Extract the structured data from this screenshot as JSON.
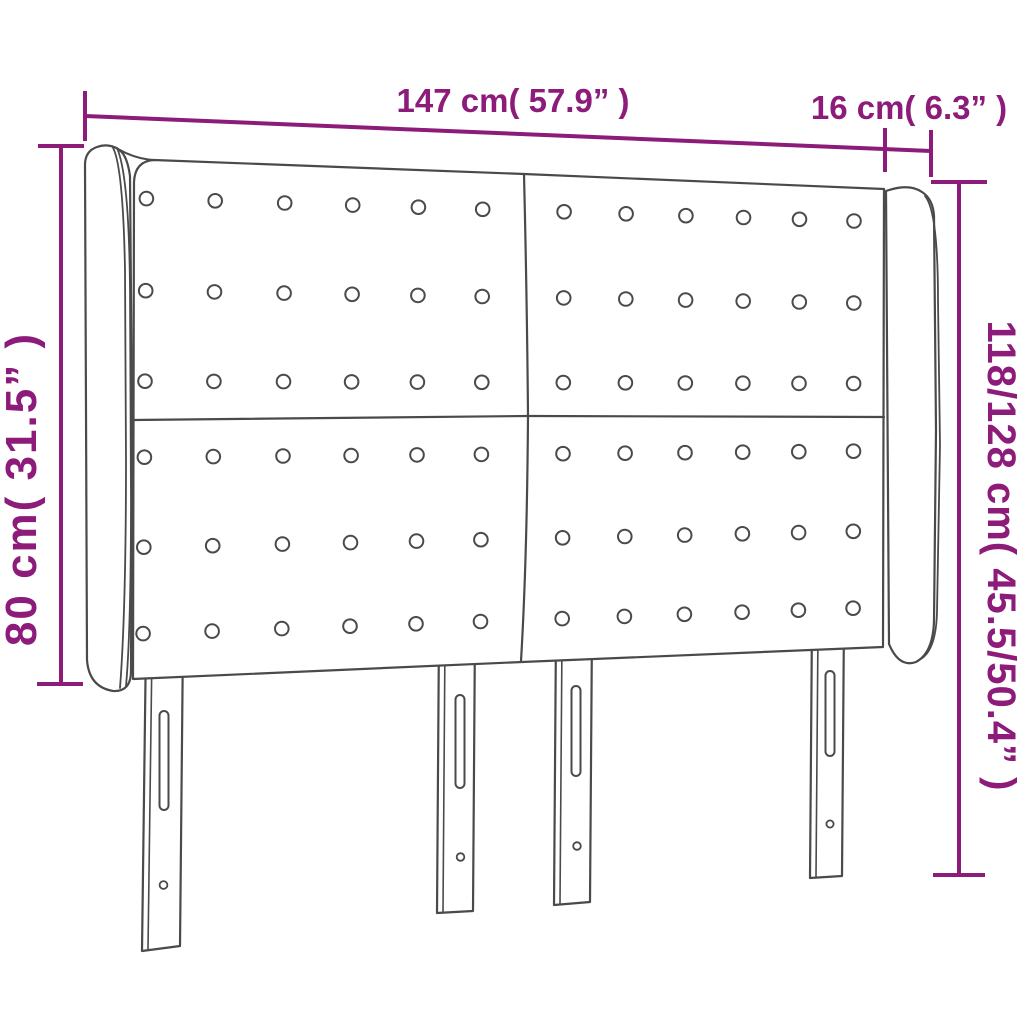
{
  "page": {
    "background": "#ffffff"
  },
  "diagram": {
    "subject": "headboard-with-ears-dimension-diagram",
    "outline_color": "#4a4a4a",
    "dimension_color": "#8c1b79"
  },
  "dimensions": {
    "width_label": "147 cm( 57.9” )",
    "ear_depth_label": "16 cm( 6.3” )",
    "headboard_height_label": "80 cm( 31.5” )",
    "total_height_label": "118/128 cm( 45.5/50.4” )"
  }
}
